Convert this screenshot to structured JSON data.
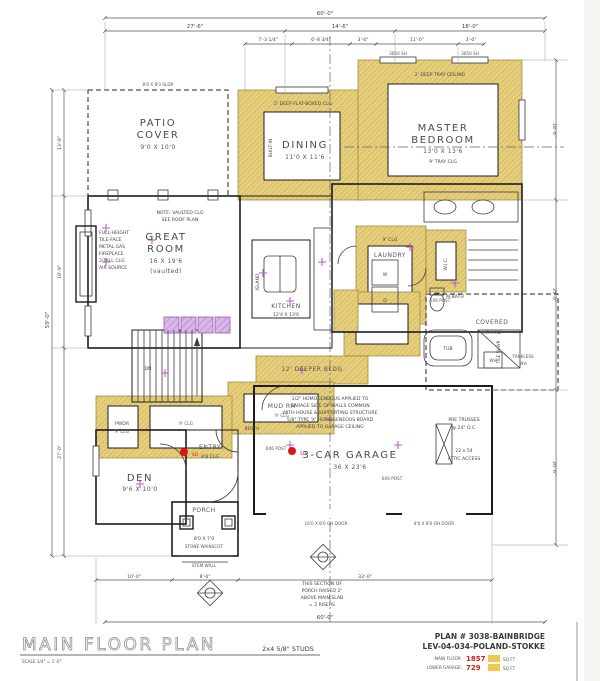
{
  "title_block": {
    "title": "MAIN FLOOR PLAN",
    "scale": "SCALE 1/4\" = 1'-0\"",
    "studs": "2x4 5/8\" STUDS",
    "plan_no": "PLAN # 3038-BAINBRIDGE",
    "plan_rev": "LEV-04-034-POLAND-STOKKE",
    "area1_label": "MAIN FLOOR:",
    "area1_value": "1857",
    "area1_unit": "SQ FT",
    "area2_label": "LOWER GARAGE:",
    "area2_value": "729",
    "area2_unit": "SQ FT"
  },
  "rooms": {
    "patio1": "PATIO",
    "patio2": "COVER",
    "patio_dims": "9'0 X 10'0",
    "great1": "GREAT",
    "great2": "ROOM",
    "great_dims": "16 X 19'6",
    "great_vault": "(vaulted)",
    "dining": "DINING",
    "dining_dims": "11'0 X 11'6",
    "master1": "MASTER",
    "master2": "BEDROOM",
    "master_dims": "13'0 X 13'6",
    "master_clg": "9' TRAY CLG",
    "kitchen": "KITCHEN",
    "kitchen_dims": "12'4 X 13'6",
    "island": "ISLAND",
    "laundry": "LAUNDRY",
    "den": "DEN",
    "den_dims": "9'6 X 10'0",
    "entry": "ENTRY",
    "entry_clg": "9'8 CLG",
    "porch": "PORCH",
    "porch_dims": "8'0 X 7'0",
    "garage": "3-CAR GARAGE",
    "garage_dims": "36 X 23'6",
    "mud": "MUD RM",
    "pwdr": "PWDR",
    "wic": "W.I.C.",
    "bath": "M.BATH",
    "cov1": "COVERED",
    "cov2": "PATIO",
    "stairs": "DN",
    "band": "12' DEEPER BLDG",
    "clg9": "9' CLG",
    "bench": "BENCH",
    "tub": "TUB",
    "shower": "TILE SHWR",
    "wd_w": "W",
    "wd_d": "D",
    "wh": "WH"
  },
  "notes": {
    "dining_clg": "2' DEEP FLAT-BOXED CLG",
    "master_clg_note": "2' DEEP TRAY CEILING",
    "great_note1": "NOTE: VAULTED CLG",
    "great_note2": "SEE ROOF PLAN",
    "fp1": "FULL-HEIGHT",
    "fp2": "TILE-FACE",
    "fp3": "METAL GAS",
    "fp4": "FIREPLACE",
    "fp5": "2-TALL CLG",
    "fp6": "AIR SOURCE",
    "gar1": "1/2\" HOMOGENEOUS APPLIED TO",
    "gar2": "GARAGE SIDE OF WALLS COMMON",
    "gar3": "WITH HOUSE & SUPPORTING STRUCTURE",
    "gar4": "5/8\" TYPE 'X' HOMOGENEOUS BOARD",
    "gar5": "APPLIED TO GARAGE CEILING",
    "porch1": "THIS SECTION OF",
    "porch2": "PORCH RAISED 2\"",
    "porch3": "ABOVE MAIN SLAB",
    "porch4": "= 2 RISERS",
    "truss1": "PRE TRUSSES",
    "truss2": "@ 24\" O.C.",
    "attic1": "22 x 54",
    "attic2": "ATTIC ACCESS",
    "post": "6X6 POST",
    "wainscot": "STONE WAINSCOT",
    "stem": "STEM WALL",
    "wh1": "TANKLESS",
    "wh2": "WH",
    "builtin": "BUILT-IN",
    "door1": "16'0 X 8'0 OH DOOR",
    "door2": "8'0 X 8'0 OH DOOR",
    "win_sh": "3050 SH",
    "win_sldr": "8'0 X 8'0 SLDR",
    "sd": "SD"
  },
  "dims": {
    "total_top": "60'-0\"",
    "t1": "27'-6\"",
    "t2": "14'-6\"",
    "t3": "18'-0\"",
    "t4": "7'-3 1/4\"",
    "t5": "6'-8 3/4\"",
    "t6": "3'-0\"",
    "t7": "11'-0\"",
    "t8": "3'-0\"",
    "left_total": "59'-0\"",
    "l1": "13'-9\"",
    "l2": "19'-9\"",
    "l3": "27'-0\"",
    "r1": "18'-6\"",
    "r2": "25'-0\"",
    "r3": "20'-6\"",
    "b1": "10'-0\"",
    "b2": "8'-6\"",
    "b3": "33'-0\"",
    "total_bottom": "60'-0\""
  }
}
